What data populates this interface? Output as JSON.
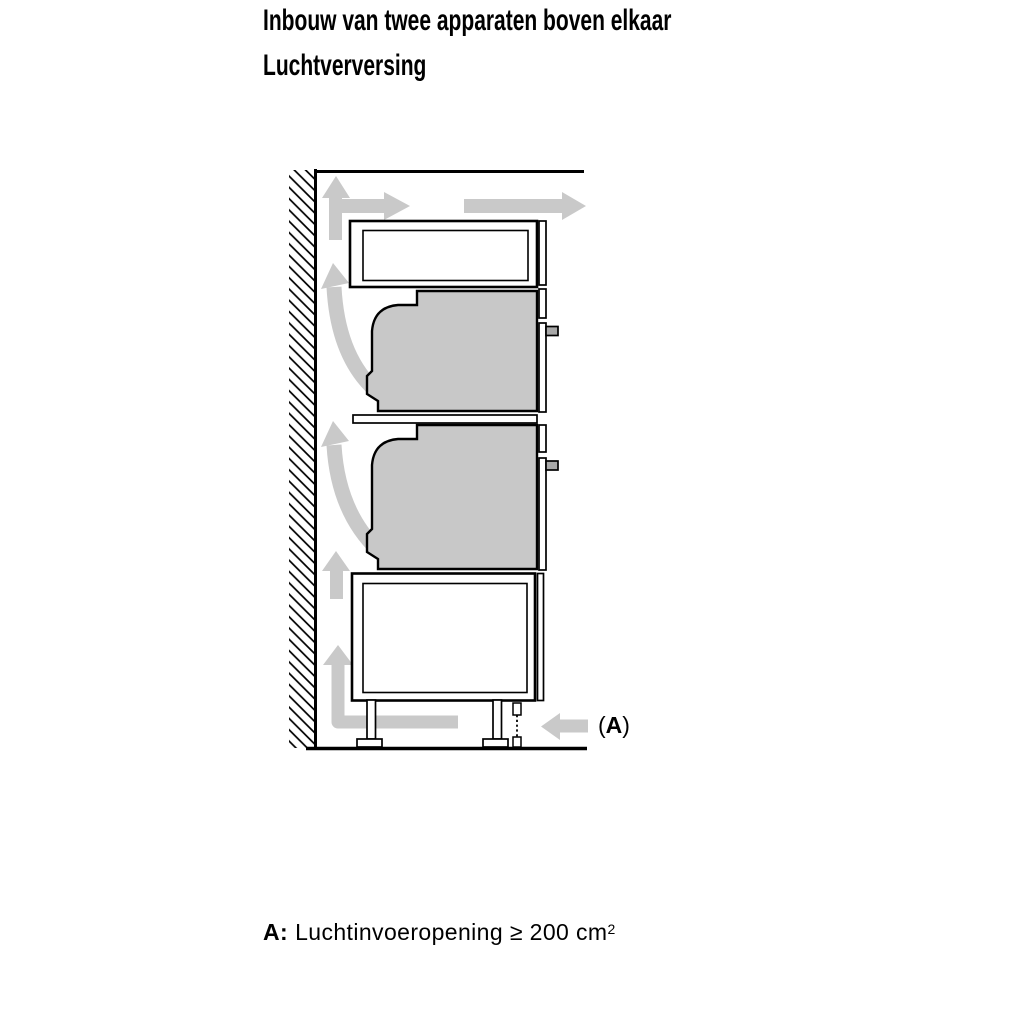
{
  "header": {
    "title": "Inbouw van twee apparaten boven elkaar",
    "subtitle": "Luchtverversing"
  },
  "diagram": {
    "label_a": {
      "open": "(",
      "letter": "A",
      "close": ")"
    },
    "colors": {
      "outline": "#000000",
      "airflow_arrow": "#c9c9c9",
      "appliance_fill": "#c8c8c8",
      "handle_fill": "#a8a8a8",
      "cabinet_fill": "#ffffff"
    }
  },
  "footnote": {
    "prefix": "A:",
    "body": "Luchtinvoeropening ≥ 200 cm",
    "superscript": "2"
  }
}
